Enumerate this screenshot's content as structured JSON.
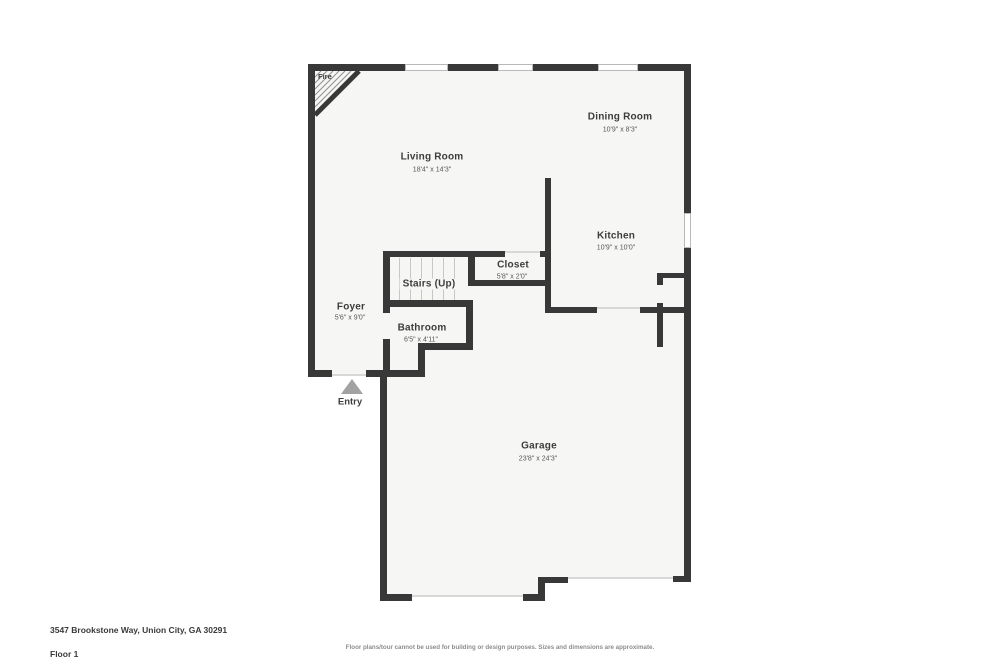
{
  "floorplan": {
    "rooms": [
      {
        "id": "living-room",
        "label": "Living Room",
        "dims": "18'4\" x 14'3\""
      },
      {
        "id": "dining-room",
        "label": "Dining Room",
        "dims": "10'9\" x 8'3\""
      },
      {
        "id": "kitchen",
        "label": "Kitchen",
        "dims": "10'9\" x 10'0\""
      },
      {
        "id": "closet",
        "label": "Closet",
        "dims": "5'8\" x 2'0\""
      },
      {
        "id": "stairs",
        "label": "Stairs (Up)",
        "dims": ""
      },
      {
        "id": "foyer",
        "label": "Foyer",
        "dims": "5'6\" x 9'0\""
      },
      {
        "id": "bathroom",
        "label": "Bathroom",
        "dims": "6'5\" x 4'11\""
      },
      {
        "id": "garage",
        "label": "Garage",
        "dims": "23'8\" x 24'3\""
      }
    ],
    "annotations": {
      "fireplace": "Fire",
      "entry": "Entry"
    }
  },
  "footer": {
    "address": "3547 Brookstone Way, Union City, GA 30291",
    "floor": "Floor 1",
    "disclaimer": "Floor plans/tour cannot be used for building or design purposes. Sizes and dimensions are approximate."
  },
  "colors": {
    "wall": "#383838",
    "floor_fill": "#f6f6f5",
    "window_frame": "#b9b9b9",
    "opening_line": "#d8d8d6",
    "entry_arrow": "#a2a2a2",
    "room_label_text": "#3d3d3d",
    "dimension_text": "#565656",
    "footer_text": "#3a3a3a",
    "disclaimer_text": "#8d8d8d"
  }
}
